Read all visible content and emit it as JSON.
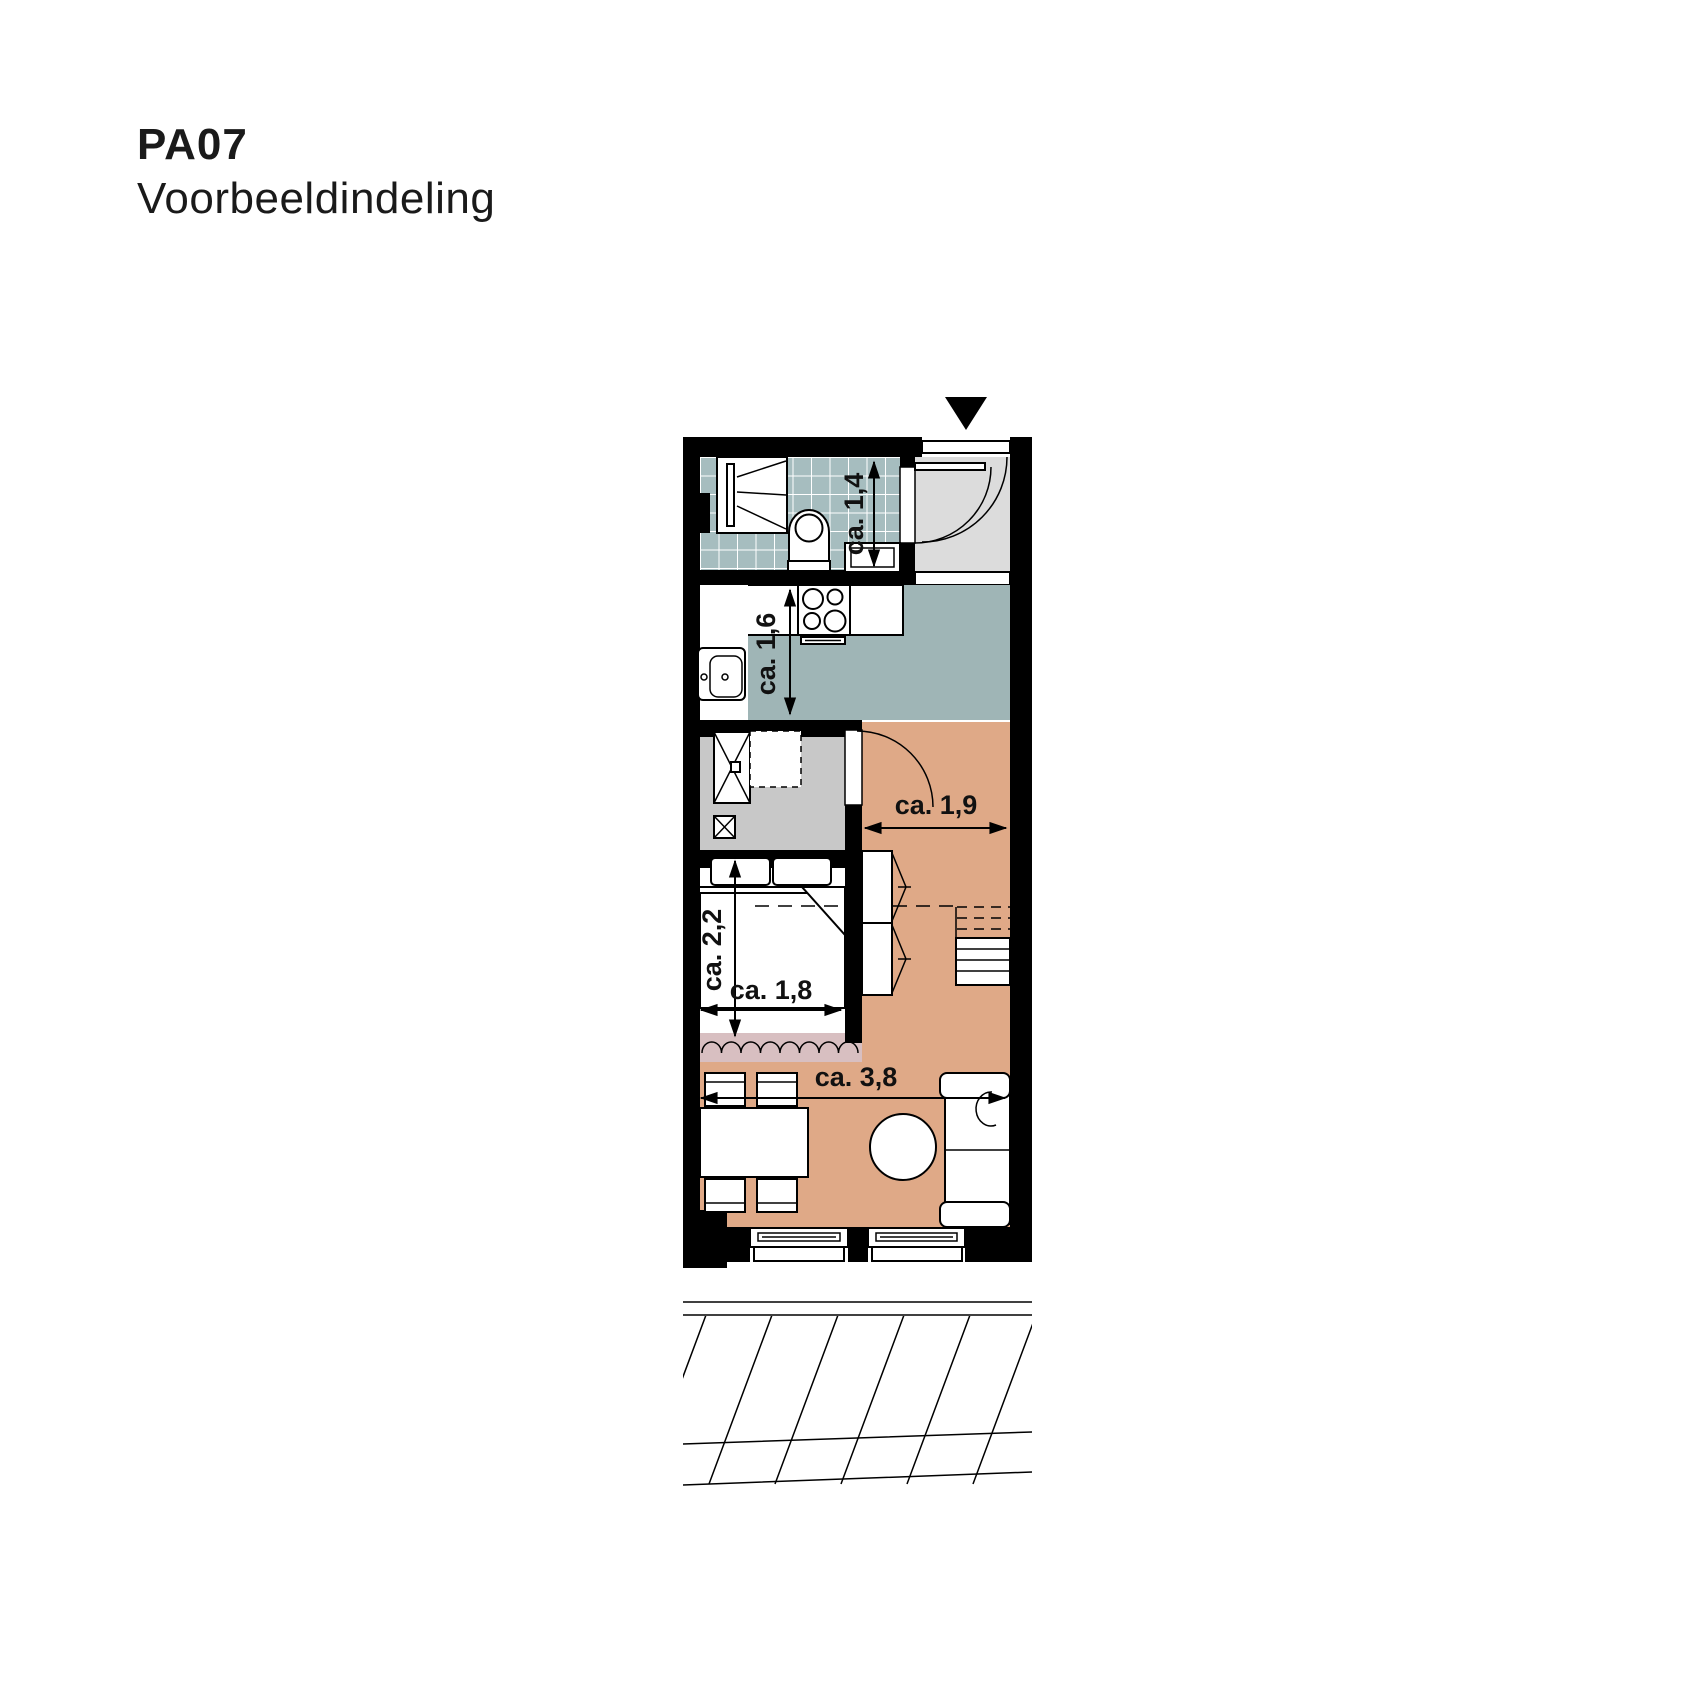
{
  "header": {
    "code": "PA07",
    "subtitle": "Voorbeeldindeling"
  },
  "plan": {
    "dimension_labels": {
      "bathroom_depth": "ca. 1,4",
      "kitchen_depth": "ca. 1,6",
      "hall_width": "ca. 1,9",
      "bedroom_depth": "ca. 2,2",
      "bedroom_width": "ca. 1,8",
      "living_width": "ca. 3,8"
    },
    "colors": {
      "wall": "#000000",
      "bathroom_tile": "#a6bdbf",
      "kitchen_floor": "#9fb5b6",
      "hall_floor": "#dcdcdc",
      "utility_floor": "#c8c8c8",
      "living_floor": "#dfa987",
      "curtain_zone": "#d8bfc1"
    },
    "icons": {
      "entrance_marker": "black-triangle-down"
    }
  }
}
